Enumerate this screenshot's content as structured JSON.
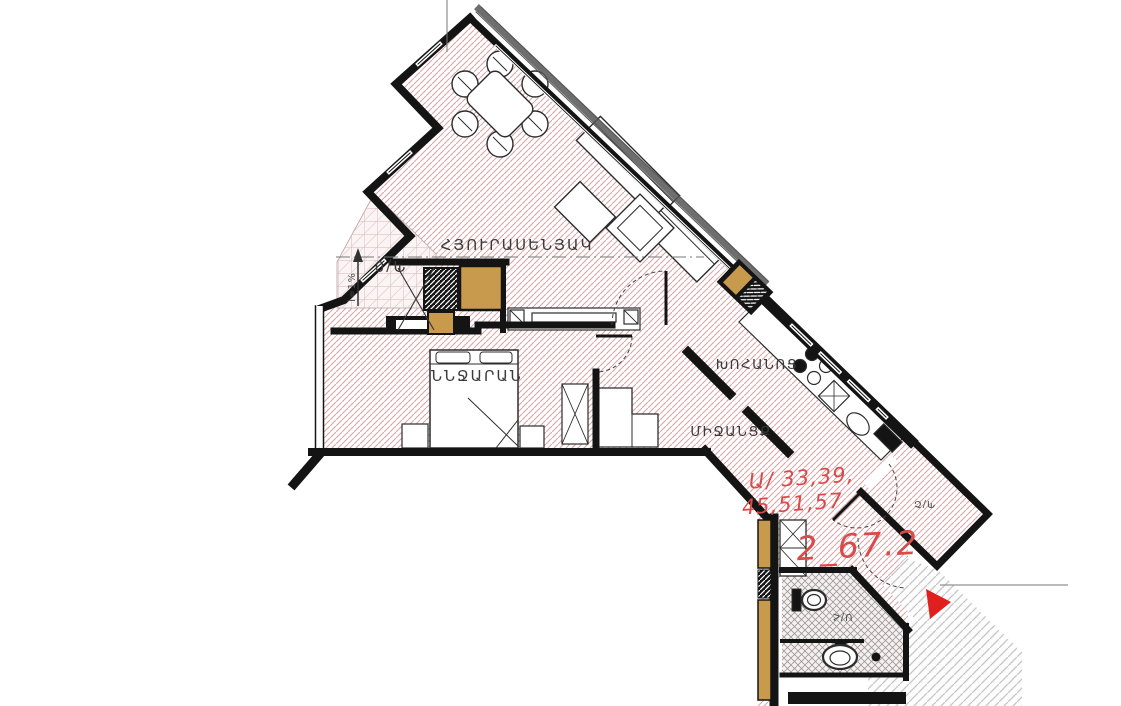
{
  "plan": {
    "title": "apartment-floor-plan",
    "rooms": {
      "living": "ՀՅՈՒՐԱՍԵՆՅԱԿ",
      "bedroom": "ՆՆՋԱՐԱՆ",
      "kitchen": "ԽՈՀԱՆՈՑ",
      "corridor": "ՄԻՋԱՆՑՔ",
      "bathroom": "Ս/Հ",
      "balcony_top": "Պ/0",
      "balcony_side": "Պ/Շ",
      "slope_note": "i=1%"
    },
    "annotations": {
      "apartment_numbers_line1": "Ա/ 33,39,",
      "apartment_numbers_line2": "45,51,57",
      "area_label": "2_67.2"
    },
    "colors": {
      "hatch_pink": "#d8a8a8",
      "hatch_gray": "#c6c6c6",
      "wood_tan": "#c89a4e",
      "red_text": "#d94b4b",
      "red_arrow": "#e01f1f",
      "wall_black": "#141414"
    }
  }
}
